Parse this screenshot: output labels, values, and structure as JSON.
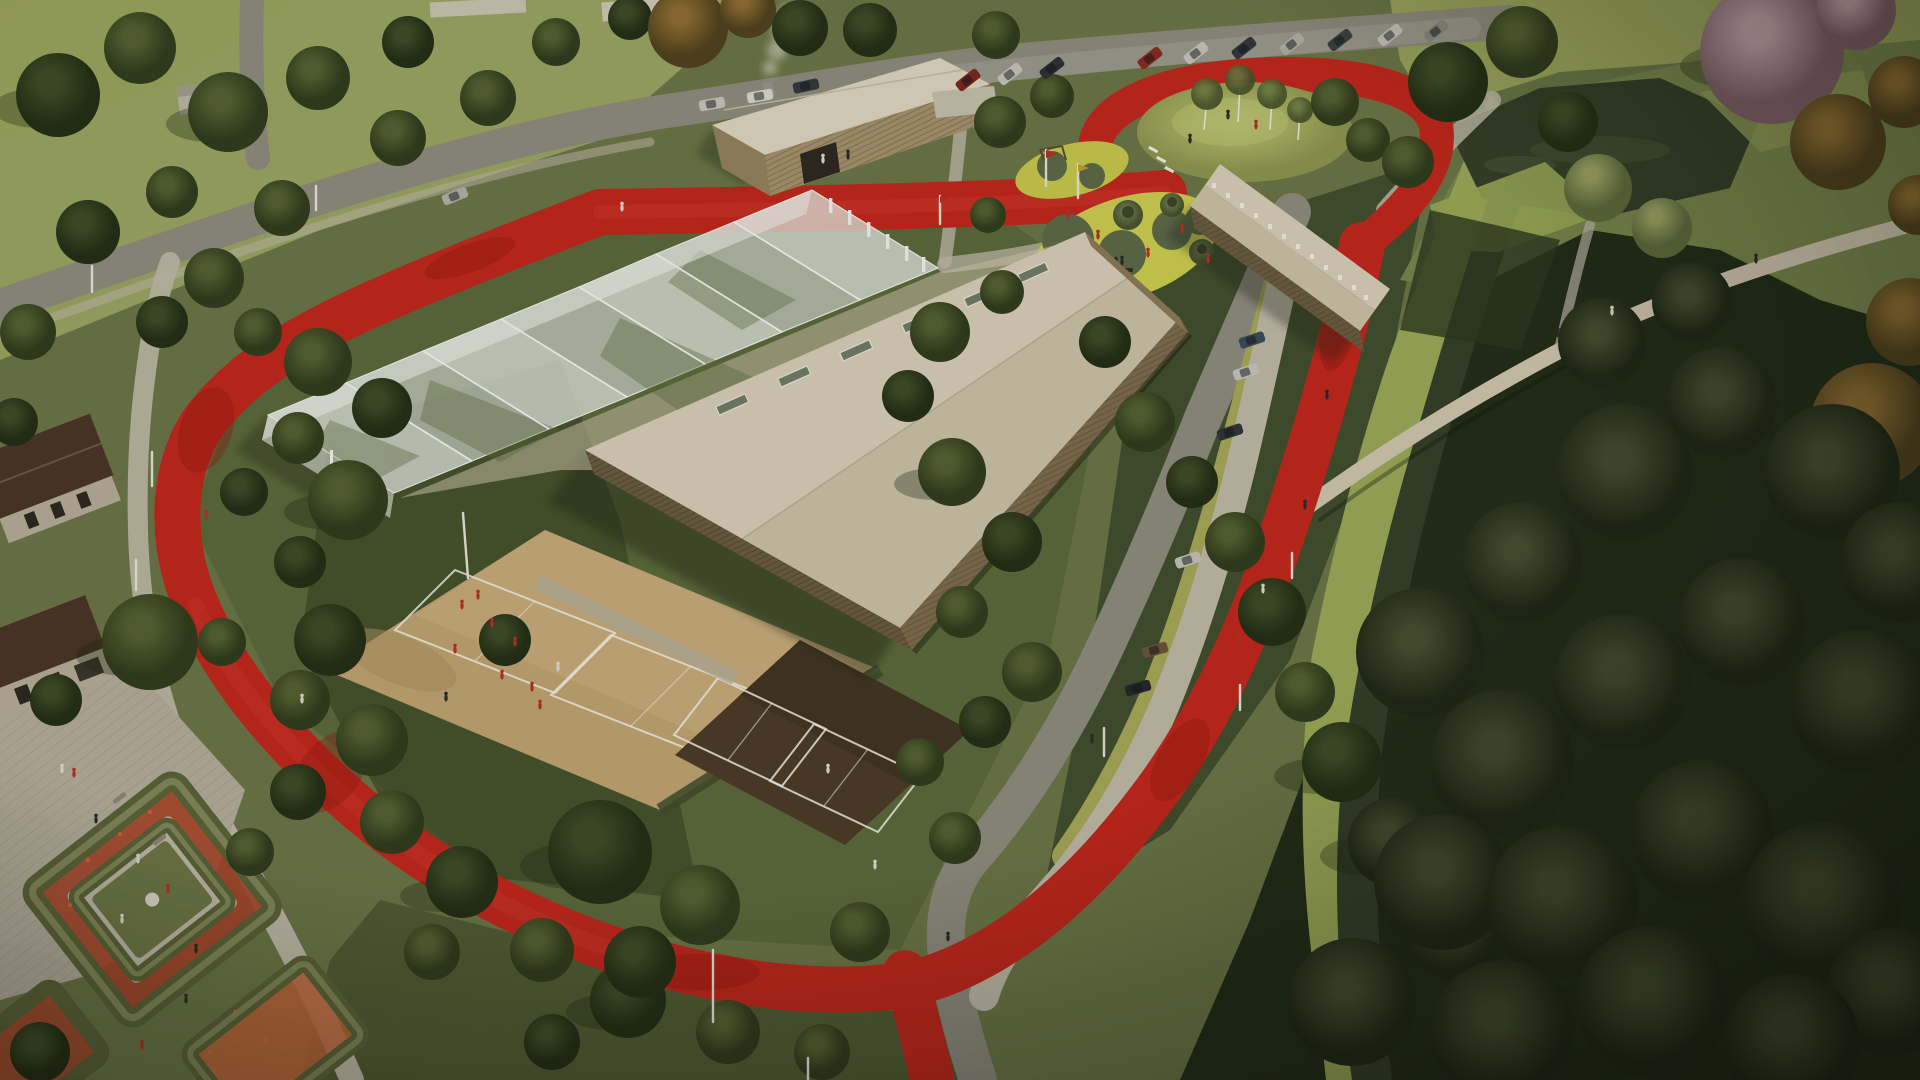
{
  "scene": {
    "title": "Aerial architectural rendering of a park sports campus with a red running loop",
    "type": "3D visualization, bird's-eye view, afternoon light, muted olive tones",
    "features": {
      "running_track": "red rubber running loop encircling the campus with a circular spur around a play mound",
      "sports_hall": "large beige gabled roof hall with timber-slat facades and roof skylights",
      "greenhouse_hall": "translucent multi-bay glass court hall",
      "pavilion": "two-storey timber pavilion with chimney steam",
      "annex": "long narrow timber annex with ridge skylights",
      "beach_courts": "sand volleyball courts with players in red",
      "badminton_courts": "dark clay courts with white line markings",
      "playground": "yellow organic playground pads with fitness equipment and grass mounds",
      "mound": "grass hill with birch trees inside the track circle",
      "pond_and_canal": "dark pond and drainage canal with bright green banks and a footbridge",
      "parking": "street with diagonal parking bays and parked cars",
      "plaza": "cobbled plaza by brick buildings",
      "flower_garden": "hedge-walled garden beds filled with red flowers",
      "vegetation": "scattered olive-green park trees and a dense dark forest edge"
    }
  },
  "palette": {
    "ground_base": "#6b7446",
    "grass_light": "#99a362",
    "grass_mid": "#5a6639",
    "grass_dark": "#3d4927",
    "grass_shade": "#39452a",
    "grass_bank": "#9aa757",
    "forest_floor": "#212b18",
    "field_top": "#9aa35c",
    "track_red": "#c0251c",
    "track_red_dark": "#8c150f",
    "track_red_light": "#d8493a",
    "road_gray": "#8d8a7e",
    "road_edge": "#a49e8e",
    "path_light": "#beb7a7",
    "path_warm": "#cfc4ae",
    "parking_olive": "#a5a658",
    "sand": "#bfa171",
    "sand_light": "#cdb284",
    "court_dark": "#4a3a28",
    "court_dark2": "#3c3020",
    "line_white": "#f2efe6",
    "roof_beige": "#d7cdb8",
    "roof_beige_dark": "#c9bfa7",
    "roof_pale": "#ddd4c0",
    "glass_white": "#e4e7e0",
    "glass_gray": "#c9cfc4",
    "wood_dark": "#6b5a42",
    "wood_mid": "#7c6a4e",
    "wood_light": "#a5906c",
    "brick_dark": "#4a3326",
    "stone_light": "#b5ab97",
    "plaza_cobble": "#b3ab9b",
    "playground_yellow": "#c6c64d",
    "playground_circle": "#5c6847",
    "water_dark": "#333d28",
    "hedge_green": "#5a6138",
    "hedge_top": "#8a9060",
    "flower_red": "#a8442a",
    "flower_orange": "#c2653a",
    "mound_green": "#a8ae62",
    "steam_white": "#e8e6e0",
    "people_red": "#b03024",
    "people_white": "#ddd8cc",
    "people_dark": "#2a2a26",
    "pole_white": "#e5e2d8",
    "shadow": "#1c2412"
  }
}
